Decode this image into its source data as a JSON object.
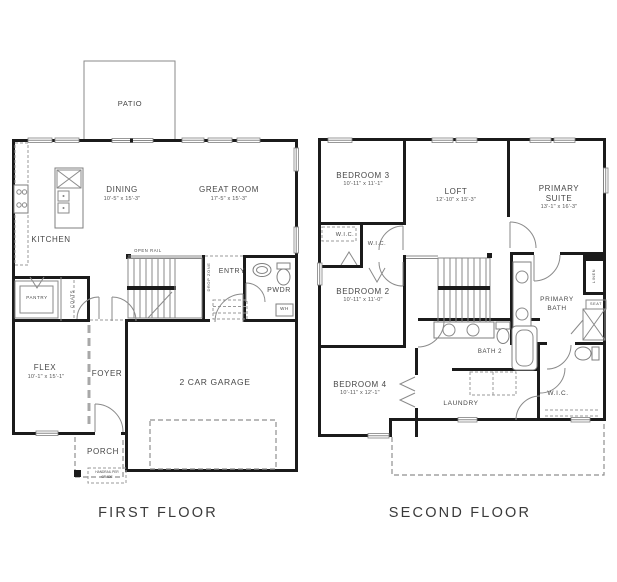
{
  "first_floor": {
    "title": "FIRST FLOOR",
    "rooms": {
      "patio": "PATIO",
      "dining": "DINING",
      "dining_dims": "10'-5\" x 15'-3\"",
      "great_room": "GREAT ROOM",
      "great_room_dims": "17'-5\" x 15'-3\"",
      "kitchen": "KITCHEN",
      "pantry": "PANTRY",
      "coats": "COATS",
      "open_rail": "OPEN RAIL",
      "drop_zone": "DROP ZONE",
      "entry": "ENTRY",
      "pwdr": "PWDR",
      "wh": "WH",
      "flex": "FLEX",
      "flex_dims": "10'-1\" x 15'-1\"",
      "foyer": "FOYER",
      "garage": "2 CAR GARAGE",
      "porch": "PORCH",
      "handrail_note_1": "HANDRAIL PER",
      "handrail_note_2": "GRADE"
    }
  },
  "second_floor": {
    "title": "SECOND FLOOR",
    "rooms": {
      "bedroom3": "BEDROOM 3",
      "bedroom3_dims": "10'-11\" x 11'-1\"",
      "loft": "LOFT",
      "loft_dims": "12'-10\" x 15'-3\"",
      "primary_suite_1": "PRIMARY",
      "primary_suite_2": "SUITE",
      "primary_suite_dims": "13'-1\" x 16'-3\"",
      "wic": "W.I.C.",
      "bedroom2": "BEDROOM 2",
      "bedroom2_dims": "10'-11\" x 11'-0\"",
      "primary_bath_1": "PRIMARY",
      "primary_bath_2": "BATH",
      "linen": "LINEN",
      "seat": "SEAT",
      "bath2": "BATH 2",
      "bedroom4": "BEDROOM 4",
      "bedroom4_dims": "10'-11\" x 12'-1\"",
      "laundry": "LAUNDRY"
    }
  },
  "style": {
    "wall_color": "#1b1b1b",
    "line_color": "#8a8a8a",
    "text_color": "#474747",
    "background": "#ffffff"
  }
}
